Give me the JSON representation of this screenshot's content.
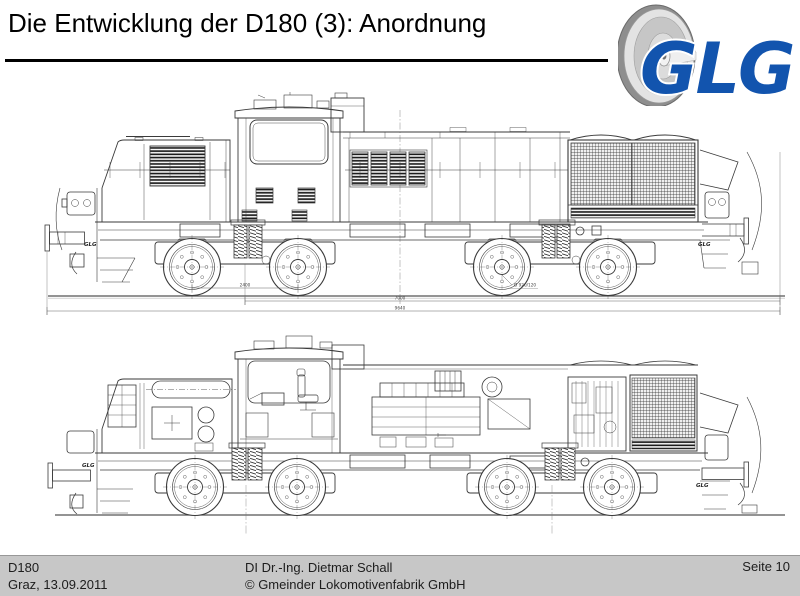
{
  "slide": {
    "title": "Die Entwicklung der D180 (3): Anordnung"
  },
  "logo": {
    "text": "GLG",
    "color": "#1254ae"
  },
  "drawing": {
    "badge": "GLG",
    "dimensions": {
      "bogie_axle_spacing": "2400",
      "wheel_diameter": "Ø 920/120",
      "pivot_distance": "7000",
      "overall_length": "9640"
    }
  },
  "footer": {
    "project": "D180",
    "place_date": "Graz, 13.09.2011",
    "author": "DI Dr.-Ing. Dietmar Schall",
    "company": "© Gmeinder Lokomotivenfabrik GmbH",
    "page": "Seite 10"
  }
}
